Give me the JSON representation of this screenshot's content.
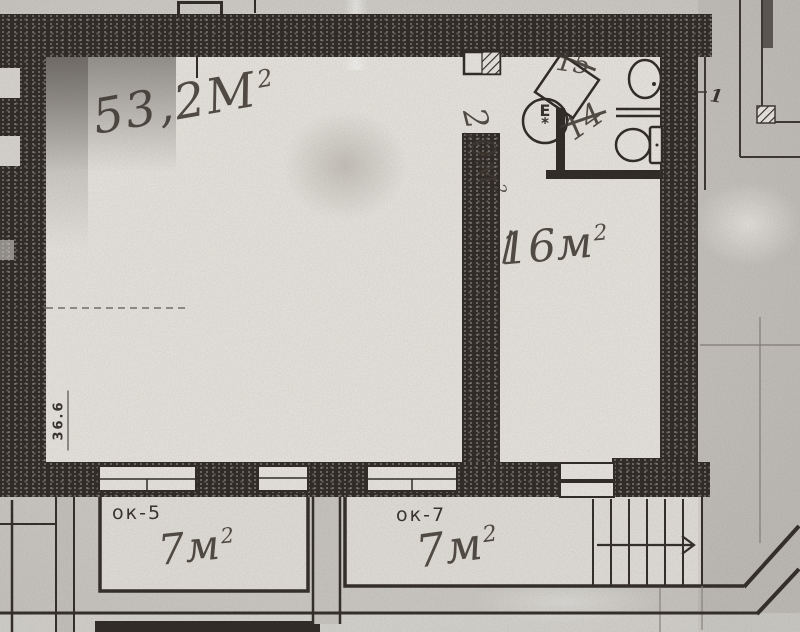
{
  "colors": {
    "paper": "#d3d0ca",
    "paper-light": "#e8e5df",
    "ink": "#2d2823",
    "print": "#35302a",
    "hand": "#3a342d"
  },
  "plan": {
    "main_room": {
      "area": "53,2М",
      "area_sup": "2",
      "printed_mark": "36.6"
    },
    "right_room": {
      "area": "16м",
      "area_sup": "2"
    },
    "bathroom": {
      "number_top": "15",
      "number_bottom": "14",
      "area": "2,0м",
      "area_sup": "2",
      "symbol": "Е",
      "symbol_star": "*"
    },
    "balcony_left": {
      "window_label": "ок-5",
      "area": "7м",
      "area_sup": "2"
    },
    "balcony_right": {
      "window_label": "ок-7",
      "area": "7м",
      "area_sup": "2"
    },
    "annex": {
      "section_mark": "1"
    }
  }
}
